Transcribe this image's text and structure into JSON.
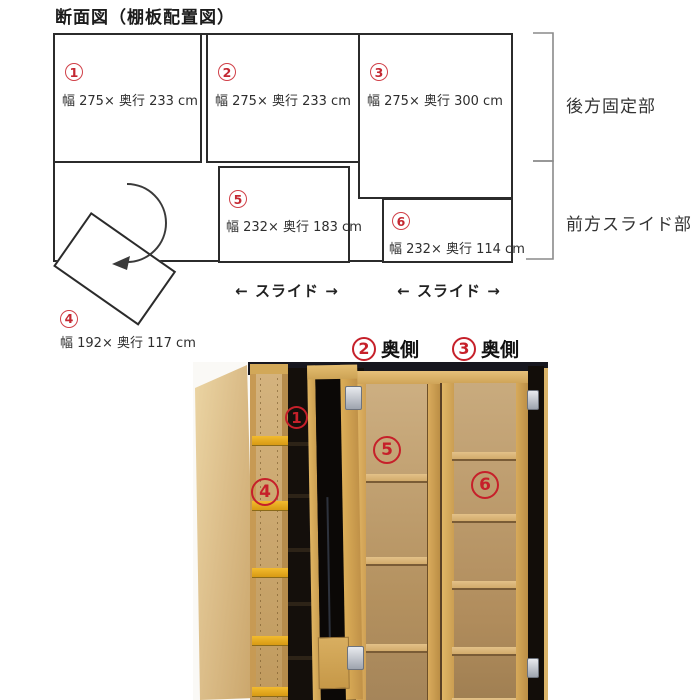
{
  "title": "断面図（棚板配置図）",
  "diagram": {
    "boxes": [
      {
        "num": "1",
        "label": "幅 275× 奥行 233 cm"
      },
      {
        "num": "2",
        "label": "幅 275× 奥行 233 cm"
      },
      {
        "num": "3",
        "label": "幅 275× 奥行 300 cm"
      },
      {
        "num": "4",
        "label": "幅 192× 奥行 117 cm"
      },
      {
        "num": "5",
        "label": "幅 232× 奥行 183 cm"
      },
      {
        "num": "6",
        "label": "幅 232× 奥行 114 cm"
      }
    ],
    "section_labels": {
      "rear": "後方固定部",
      "front": "前方スライド部"
    },
    "slide_label": "← スライド →",
    "icons": {
      "rotate_arrow": "curved arrow showing door swing",
      "brackets": "range brackets right side"
    },
    "colors": {
      "line": "#2b2b2b",
      "circle_red": "#c42832",
      "bracket_gray": "#8a8a8a"
    }
  },
  "photo": {
    "labels": [
      {
        "num": "2",
        "text": "奥側"
      },
      {
        "num": "3",
        "text": "奥側"
      }
    ],
    "markers": [
      {
        "num": "1"
      },
      {
        "num": "4"
      },
      {
        "num": "5"
      },
      {
        "num": "6"
      }
    ],
    "colors": {
      "wood_light": "#dcbe8a",
      "wood_mid": "#d0a65c",
      "wood_back": "#c3a476",
      "yellow_shelf": "#eaa81f",
      "dark_interior": "#15100b",
      "marker_red": "#c6202a",
      "hinge_silver": "#c9cdd4"
    }
  }
}
